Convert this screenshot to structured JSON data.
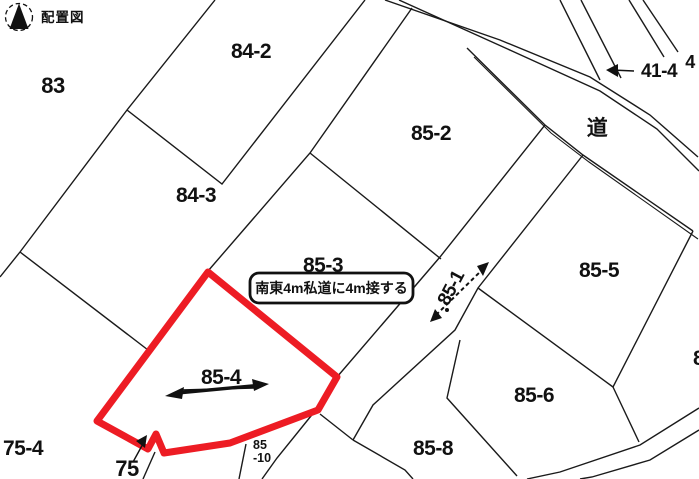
{
  "title": {
    "compass_label": "配置図"
  },
  "map": {
    "highlight_color": "#ed1c24",
    "line_color": "#1a1a1a",
    "highlighted_parcel": "85-4",
    "road_label": "道",
    "annotation": "南東4m私道に4m接する",
    "parcel_labels": {
      "p83": "83",
      "p84_2": "84-2",
      "p84_3": "84-3",
      "p85_2": "85-2",
      "p85_3": "85-3",
      "p85_4": "85-4",
      "p85_5": "85-5",
      "p85_6": "85-6",
      "p85_8": "85-8",
      "p85_10_top": "85",
      "p85_10_bottom": "-10",
      "p75_4": "75-4",
      "p75": "75",
      "p85_1": "85-1",
      "p41_4": "41-4",
      "p4": "4",
      "p8_partial": "8"
    }
  }
}
